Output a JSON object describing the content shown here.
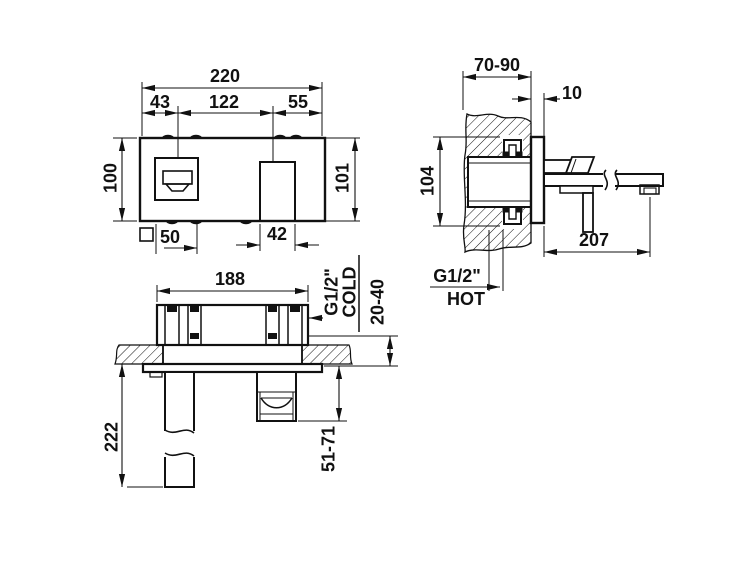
{
  "front": {
    "total": "220",
    "seg_left": "43",
    "seg_center": "122",
    "seg_right": "55",
    "height_left": "100",
    "height_right": "101",
    "handle_size": "50",
    "spout_width": "42"
  },
  "side": {
    "wall_depth": "70-90",
    "plate_gap": "10",
    "body_height": "104",
    "spout_reach": "207",
    "thread": "G1/2\"",
    "hot": "HOT"
  },
  "top": {
    "body_width": "188",
    "spout_drop": "222",
    "handle_range": "51-71",
    "mount_depth": "20-40",
    "thread": "G1/2\"",
    "cold": "COLD"
  },
  "colors": {
    "line": "#111111",
    "background": "#ffffff"
  }
}
